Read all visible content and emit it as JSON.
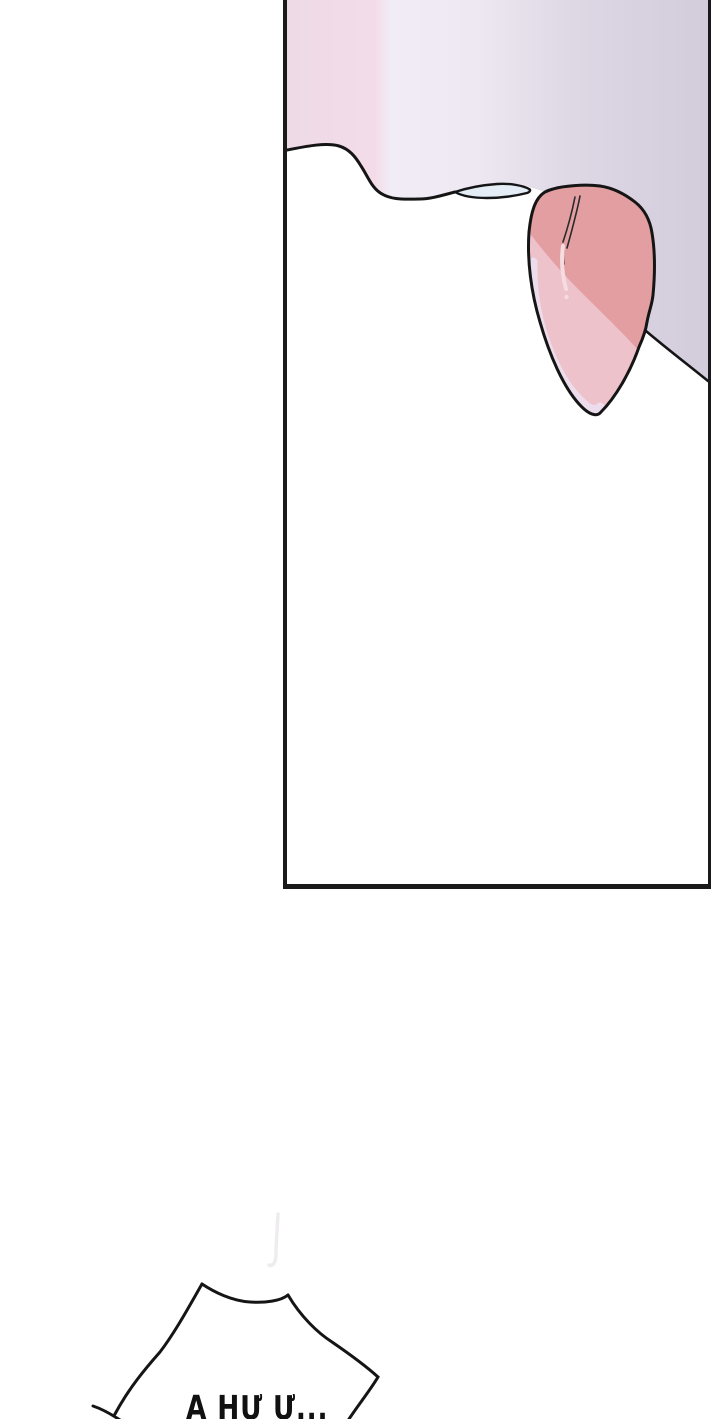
{
  "page": {
    "bg": "#ffffff"
  },
  "panel": {
    "border_color": "#1a1a1a",
    "line_color": "#151515",
    "gradient": [
      "#eed9e7",
      "#f3dce8",
      "#f1ecf5",
      "#eee8f2",
      "#ded8e5",
      "#d2ccdb"
    ],
    "fills": {
      "lens_blue": "#e4edf5",
      "ear_main": "#e39ea1",
      "ear_light": "#eec2cb",
      "ear_pale_strip": "#ebdff0",
      "ear_highlight": "#f6dbe0",
      "strand_color": "#2a2a2a"
    }
  },
  "speech_bubble": {
    "text": "A HƯ Ư...",
    "text_color": "#111111",
    "outline_color": "#151515",
    "faint_line_color": "#efecef"
  }
}
